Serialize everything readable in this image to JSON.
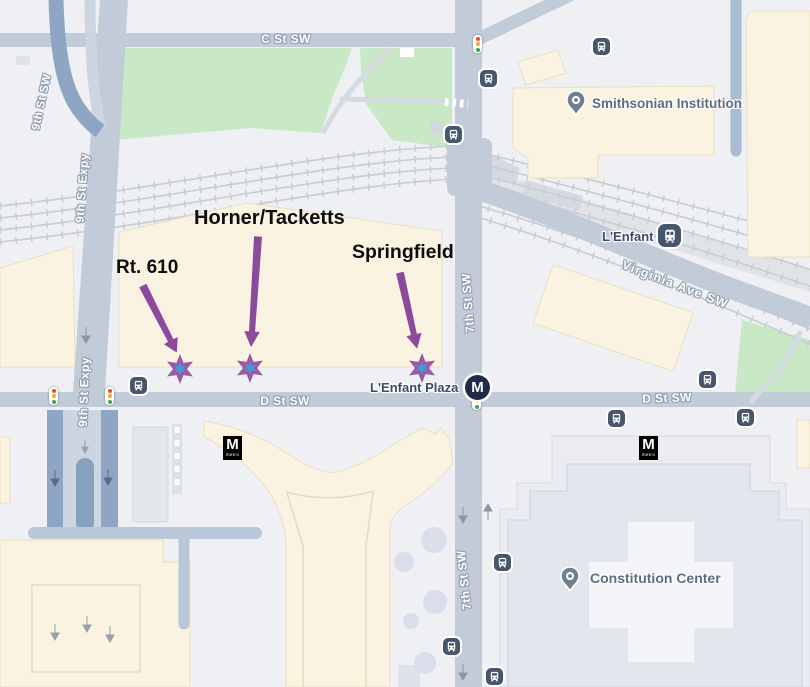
{
  "streets": {
    "c_st": "C St SW",
    "d_st": "D St SW",
    "seventh_st": "7th St SW",
    "ninth_st": "9th St SW",
    "ninth_expy": "9th St Expy",
    "virginia_ave": "Virginia Ave SW"
  },
  "pois": {
    "smithsonian": "Smithsonian Institution",
    "lenfant_station": "L'Enfant",
    "lenfant_plaza": "L'Enfant Plaza",
    "constitution_center": "Constitution Center"
  },
  "annotations": [
    {
      "label": "Rt. 610"
    },
    {
      "label": "Horner/Tacketts"
    },
    {
      "label": "Springfield"
    }
  ],
  "metro": {
    "initial": "M",
    "wordmark": "metro"
  },
  "icons": {
    "bus_stop": "bus-icon",
    "rail_station": "train-icon",
    "traffic_signal": "traffic-light-icon",
    "poi_pin": "map-pin-icon",
    "metro_station": "metro-m-icon"
  },
  "colors": {
    "road": "#c2ccd9",
    "expressway_lane": "#8ea6c4",
    "park": "#c9e8c6",
    "building": "#faf3e1",
    "annotation_arrow": "#8d4a9c",
    "stop_star": "#9c58a6",
    "stop_star_center": "#3f9cd4",
    "background": "#eef0f3"
  }
}
